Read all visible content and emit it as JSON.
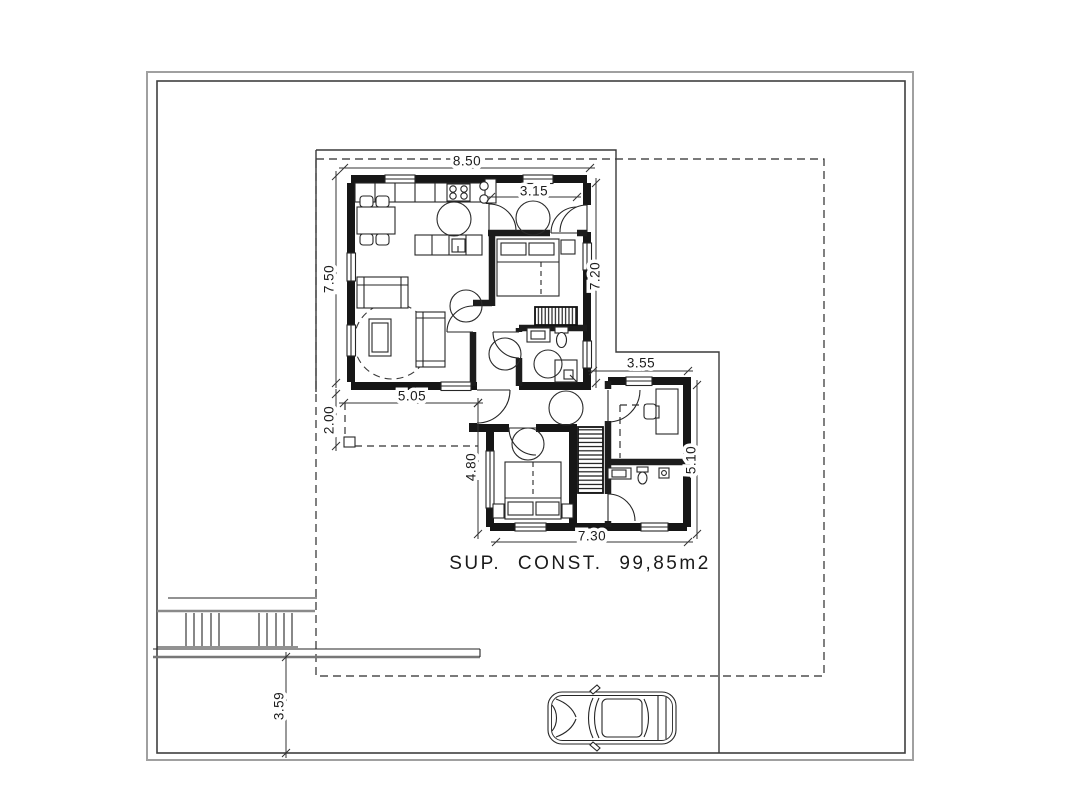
{
  "plan": {
    "area_label": "SUP. CONST. 99,85m2",
    "dimensions": {
      "top_width": "8.50",
      "left_height": "7.50",
      "kitchen_corridor": "3.15",
      "right_height": "7.20",
      "porch_width": "5.05",
      "porch_depth": "2.00",
      "lower_left_height": "4.80",
      "wing_top_width": "3.55",
      "wing_right_height": "5.10",
      "bottom_width": "7.30",
      "driveway_depth": "3.59"
    },
    "colors": {
      "ink": "#1c1c1c",
      "boundary_outer_gray": "#a0a0a0",
      "boundary_inner_gray": "#3f3f3f",
      "paper": "#ffffff"
    }
  }
}
